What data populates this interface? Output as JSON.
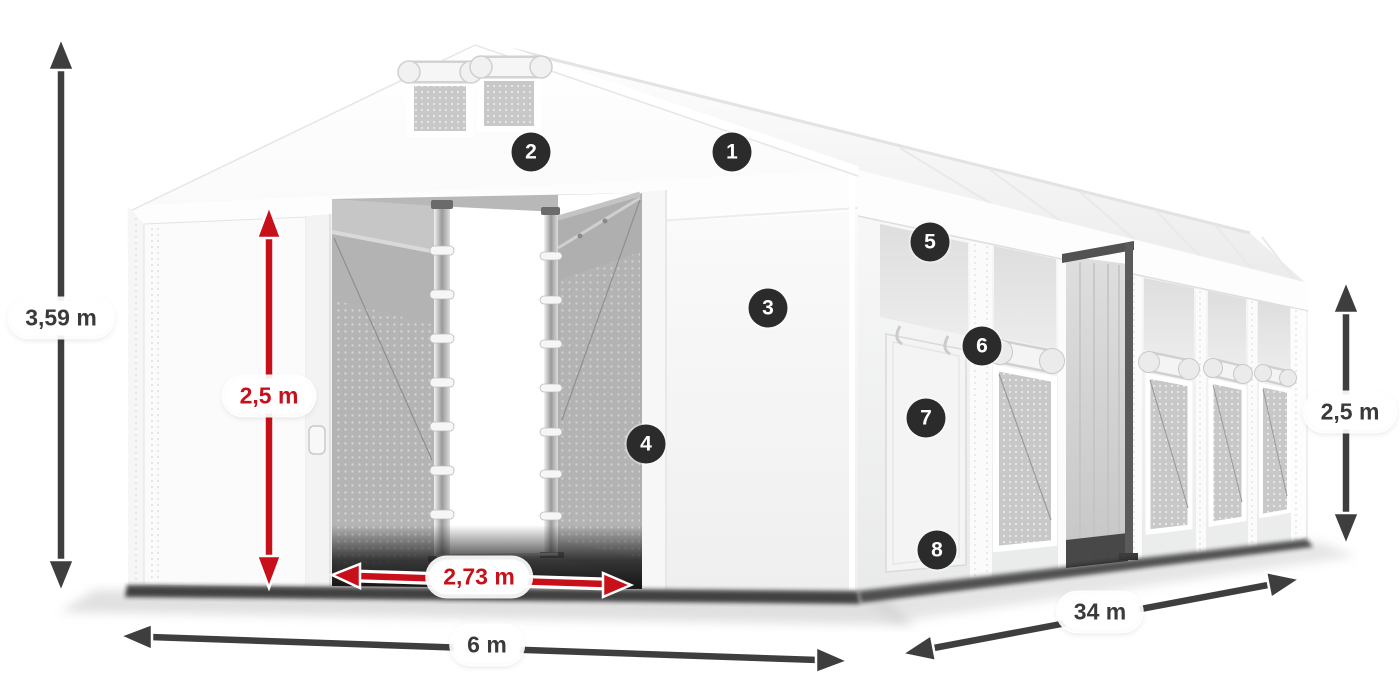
{
  "diagram": {
    "dimensions": {
      "total_height": "3,59 m",
      "entrance_height": "2,5 m",
      "entrance_width": "2,73 m",
      "front_width": "6 m",
      "side_length": "34 m",
      "side_wall_height": "2,5 m"
    },
    "callouts": [
      {
        "number": "1"
      },
      {
        "number": "2"
      },
      {
        "number": "3"
      },
      {
        "number": "4"
      },
      {
        "number": "5"
      },
      {
        "number": "6"
      },
      {
        "number": "7"
      },
      {
        "number": "8"
      }
    ],
    "colors": {
      "dimension_arrow": "#3e3e3e",
      "highlight_arrow": "#c8101a",
      "badge_background": "#2b2b2b",
      "badge_text": "#ffffff",
      "label_background": "#ffffff",
      "label_text_dark": "#3a3a3a",
      "label_text_red": "#c8101a"
    }
  }
}
